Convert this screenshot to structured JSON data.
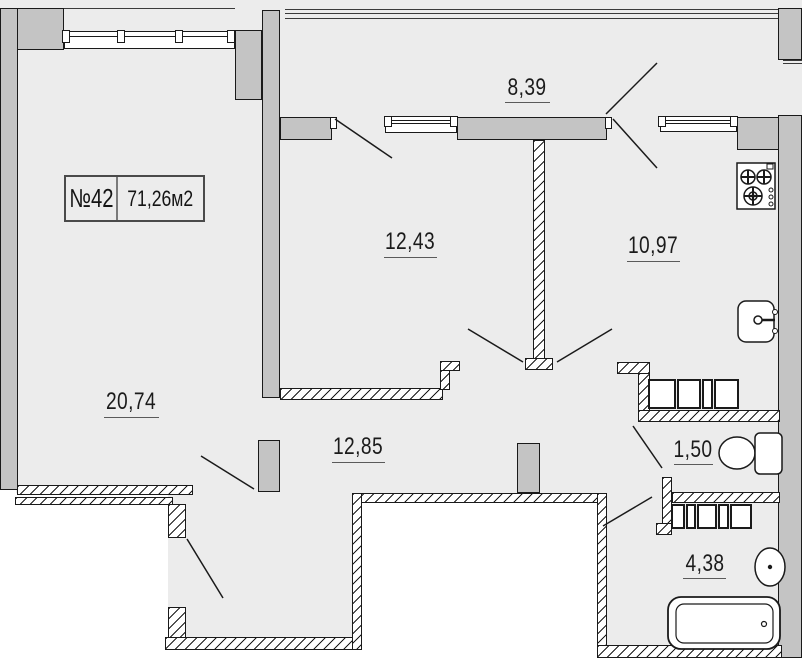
{
  "plan": {
    "apartment_number": "№42",
    "total_area": "71,26м2",
    "rooms": [
      {
        "name": "balcony",
        "area": "8,39"
      },
      {
        "name": "room",
        "area": "12,43"
      },
      {
        "name": "kitchen",
        "area": "10,97"
      },
      {
        "name": "living-room",
        "area": "20,74"
      },
      {
        "name": "hallway",
        "area": "12,85"
      },
      {
        "name": "wc",
        "area": "1,50"
      },
      {
        "name": "bathroom",
        "area": "4,38"
      }
    ]
  },
  "colors": {
    "background": "#ececec",
    "exterior": "#ffffff",
    "wall_fill": "#c4c4c4",
    "line": "#1a1a1a"
  },
  "fixtures": [
    "stove-icon",
    "kitchen-sink-icon",
    "toilet-icon",
    "washbasin-icon",
    "bathtub-icon",
    "kitchen-counter-units",
    "bathroom-cabinet-units"
  ]
}
